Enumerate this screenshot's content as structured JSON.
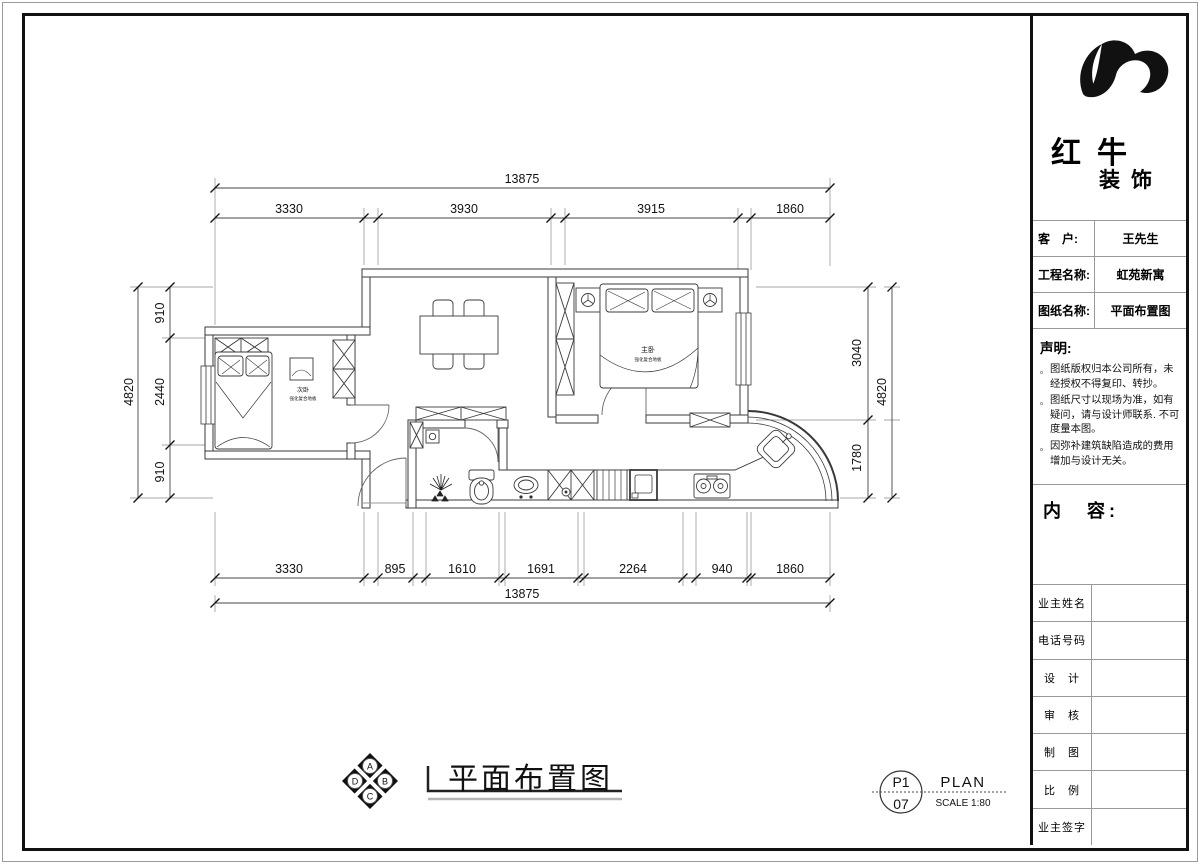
{
  "titleblock": {
    "brand": {
      "line1": "红牛",
      "line2": "装饰"
    },
    "info_rows": [
      {
        "label": "客　户:",
        "value": "王先生"
      },
      {
        "label": "工程名称:",
        "value": "虹苑新寓"
      },
      {
        "label": "图纸名称:",
        "value": "平面布置图"
      }
    ],
    "statement": {
      "title": "声明:",
      "bullet": "。",
      "items": [
        "图纸版权归本公司所有，未经授权不得复印、转抄。",
        "图纸尺寸以现场为准，如有疑问，请与设计师联系. 不可度量本图。",
        "因弥补建筑缺陷造成的费用增加与设计无关。"
      ]
    },
    "content_label": "内　容:",
    "sign_rows": [
      {
        "label": "业主姓名"
      },
      {
        "label": "电话号码"
      },
      {
        "label": "设　计"
      },
      {
        "label": "审　核"
      },
      {
        "label": "制　图"
      },
      {
        "label": "比　例"
      },
      {
        "label": "业主签字"
      }
    ]
  },
  "plan": {
    "rooms": [
      {
        "name": "次卧",
        "finish": "强化复合地板"
      },
      {
        "name": "主卧",
        "finish": "强化复合地板"
      }
    ],
    "dims": {
      "top": {
        "total": "13875",
        "segs": [
          "3330",
          "3930",
          "3915",
          "1860"
        ]
      },
      "bottom": {
        "total": "13875",
        "segs": [
          "3330",
          "895",
          "1610",
          "1691",
          "2264",
          "940",
          "1860"
        ]
      },
      "left": {
        "total": "4820",
        "segs": [
          "910",
          "2440",
          "910"
        ]
      },
      "right": {
        "total": "4820",
        "segs": [
          "3040",
          "1780"
        ]
      }
    }
  },
  "footer": {
    "compass": {
      "letters": [
        "A",
        "B",
        "C",
        "D"
      ]
    },
    "title": "平面布置图",
    "sheet": {
      "code": "P1",
      "number": "07",
      "type": "PLAN",
      "scale": "SCALE 1:80"
    }
  }
}
